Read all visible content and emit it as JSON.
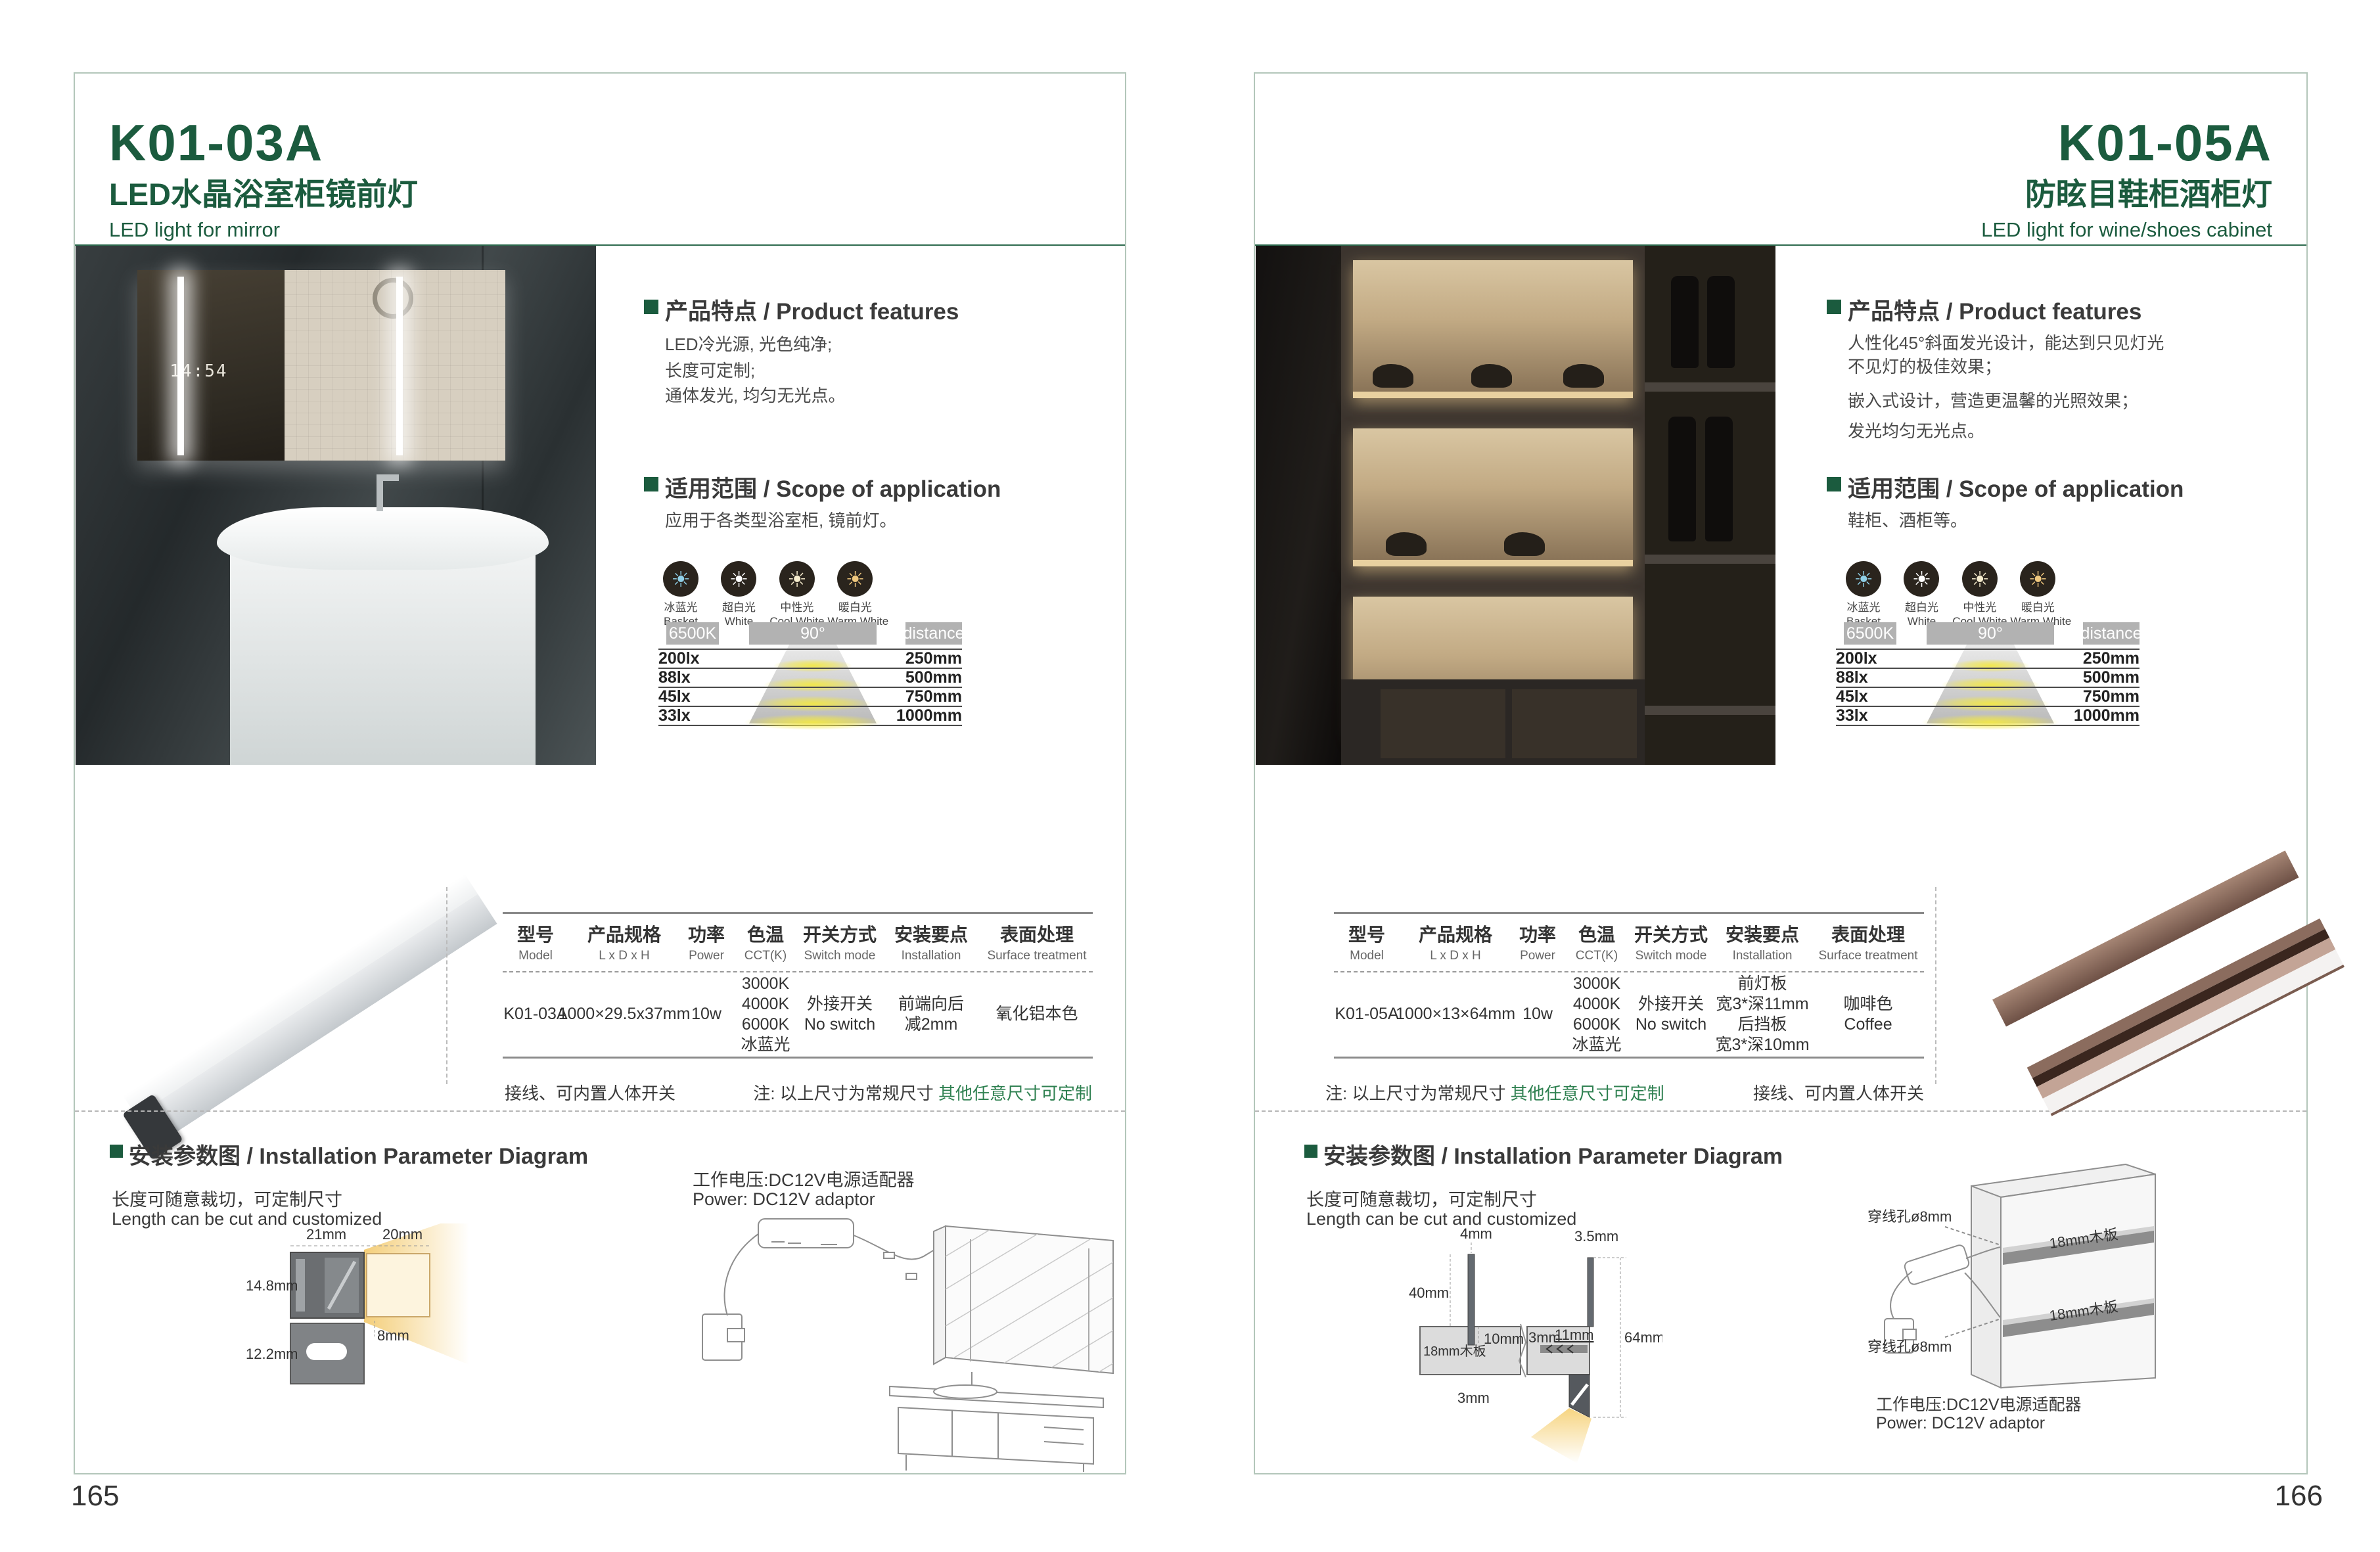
{
  "accent_green": "#1b5b3e",
  "note_green": "#2e8050",
  "shared": {
    "features_title": "产品特点 / Product features",
    "scope_title": "适用范围 / Scope of application",
    "install_title": "安装参数图 / Installation Parameter Diagram",
    "cut_note_zh": "长度可随意裁切，可定制尺寸",
    "cut_note_en": "Length can be cut and customized",
    "power_note_zh": "工作电压:DC12V电源适配器",
    "power_note_en": "Power: DC12V adaptor",
    "wire_note": "接线、可内置人体开关",
    "size_note_black": "注: 以上尺寸为常规尺寸 ",
    "size_note_green": "其他任意尺寸可定制",
    "table_headers": [
      {
        "zh": "型号",
        "en": "Model"
      },
      {
        "zh": "产品规格",
        "en": "L x D x H"
      },
      {
        "zh": "功率",
        "en": "Power"
      },
      {
        "zh": "色温",
        "en": "CCT(K)"
      },
      {
        "zh": "开关方式",
        "en": "Switch mode"
      },
      {
        "zh": "安装要点",
        "en": "Installation"
      },
      {
        "zh": "表面处理",
        "en": "Surface treatment"
      }
    ],
    "light_icons": [
      {
        "icon": "sun-icon",
        "zh": "冰蓝光",
        "en": "Basket",
        "color": "#8fd0e8"
      },
      {
        "icon": "sun-icon",
        "zh": "超白光",
        "en": "White",
        "color": "#ffffff"
      },
      {
        "icon": "sun-icon",
        "zh": "中性光",
        "en": "Cool White",
        "color": "#f6eccd"
      },
      {
        "icon": "sun-icon",
        "zh": "暖白光",
        "en": "Warm White",
        "color": "#f0c87e"
      }
    ],
    "photometric": {
      "cct_chip": "6500K",
      "angle_chip": "90°",
      "distance_chip": "distance",
      "rows": [
        {
          "lux": "200lx",
          "dist": "250mm"
        },
        {
          "lux": "88lx",
          "dist": "500mm"
        },
        {
          "lux": "45lx",
          "dist": "750mm"
        },
        {
          "lux": "33lx",
          "dist": "1000mm"
        }
      ]
    }
  },
  "left": {
    "page_number": "165",
    "model": "K01-03A",
    "title_zh": "LED水晶浴室柜镜前灯",
    "title_en": "LED light for mirror",
    "features": [
      "LED冷光源, 光色纯净;",
      "长度可定制;",
      "通体发光, 均匀无光点。"
    ],
    "scope": "应用于各类型浴室柜, 镜前灯。",
    "mirror_clock": "14:54",
    "row": {
      "model": "K01-03A",
      "size": "1000×29.5x37mm",
      "power": "10w",
      "cct": [
        "3000K",
        "4000K",
        "6000K",
        "冰蓝光"
      ],
      "switch": [
        "外接开关",
        "No switch"
      ],
      "install": [
        "前端向后",
        "减2mm"
      ],
      "surface": [
        "氧化铝本色"
      ]
    },
    "dims": {
      "w21": "21mm",
      "w20": "20mm",
      "h148": "14.8mm",
      "h122": "12.2mm",
      "s8": "8mm"
    }
  },
  "right": {
    "page_number": "166",
    "model": "K01-05A",
    "title_zh": "防眩目鞋柜酒柜灯",
    "title_en": "LED light for wine/shoes cabinet",
    "features": [
      "人性化45°斜面发光设计，能达到只见灯光",
      "不见灯的极佳效果；",
      "嵌入式设计，营造更温馨的光照效果；",
      "发光均匀无光点。"
    ],
    "scope": "鞋柜、酒柜等。",
    "row": {
      "model": "K01-05A",
      "size": "1000×13×64mm",
      "power": "10w",
      "cct": [
        "3000K",
        "4000K",
        "6000K",
        "冰蓝光"
      ],
      "switch": [
        "外接开关",
        "No switch"
      ],
      "install": [
        "前灯板",
        "宽3*深11mm",
        "后挡板",
        "宽3*深10mm"
      ],
      "surface": [
        "咖啡色",
        "Coffee"
      ]
    },
    "dims": {
      "d4": "4mm",
      "d35": "3.5mm",
      "d40": "40mm",
      "board": "18mm木板",
      "d10": "10mm",
      "d3a": "3mm",
      "d3b": "3mm",
      "d11": "11mm",
      "d64": "64mm"
    },
    "hole_label": "穿线孔ø8mm",
    "shelf_label": "18mm木板"
  }
}
